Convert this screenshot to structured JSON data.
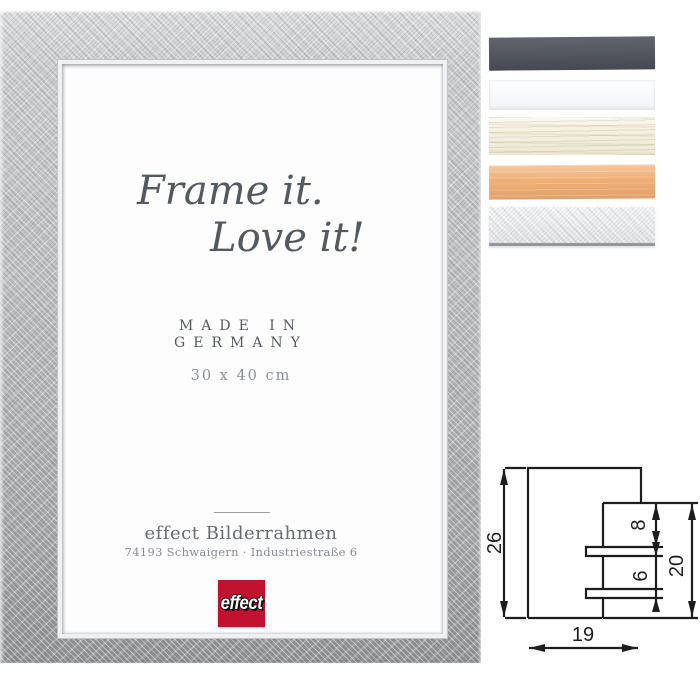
{
  "frame_preview": {
    "headline": {
      "line1": "Frame it.",
      "line2": "Love it!"
    },
    "origin": {
      "line1": "MADE IN",
      "line2": "GERMANY"
    },
    "size_label": "30 x 40 cm",
    "company": "effect Bilderrahmen",
    "address": "74193 Schwaigern · Industriestraße 6",
    "logo": {
      "text": "effect",
      "background": "#c2122f"
    }
  },
  "color_swatches": [
    {
      "name": "anthracite",
      "color": "#4f535d"
    },
    {
      "name": "white",
      "color": "#fbfcfe"
    },
    {
      "name": "cream whitewashed wood",
      "color": "#f5f1e1"
    },
    {
      "name": "apricot",
      "color": "#f0b077"
    },
    {
      "name": "silver crosshatch",
      "color": "#eaebed"
    }
  ],
  "profile_drawing": {
    "total_height_mm": "26",
    "top_to_slot_mm": "8",
    "slot_gap_mm": "6",
    "rabbet_height_mm": "20",
    "profile_width_mm": "19"
  }
}
